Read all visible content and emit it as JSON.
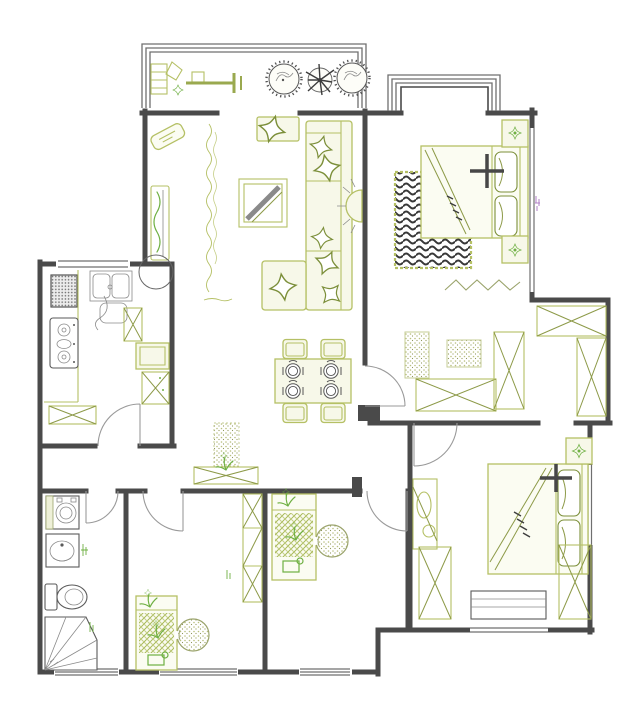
{
  "document": {
    "type": "apartment-floor-plan-drawing",
    "view": "top-down",
    "style": "CAD line drawing, black walls with olive-green furniture symbols"
  },
  "colors": {
    "wall": "#4a4a4a",
    "wall-light": "#6f6f6f",
    "furn": "#b5c065",
    "furn-dark": "#8d9a48",
    "furn-fill": "#f7f8e9",
    "plant": "#6fb043",
    "dark": "#3d3d3d",
    "door": "#9a9a9a",
    "purple": "#b07fc7",
    "bg": "#ffffff"
  },
  "rooms": [
    {
      "name": "balcony",
      "furniture": [
        "exercise-equipment-icon",
        "potted-plant-icon",
        "potted-plant-icon",
        "potted-plant-icon"
      ]
    },
    {
      "name": "living-room",
      "furniture": [
        "tv-icon",
        "tv-cabinet-icon",
        "wall-texture-scribble",
        "coffee-table-icon",
        "side-table-icon",
        "l-shaped-sofa-icon",
        "throw-pillow-icon",
        "wall-lamp-icon",
        "detail-circle-annotation"
      ]
    },
    {
      "name": "dining-area",
      "furniture": [
        "dining-table-icon",
        "chair-icon",
        "chair-icon",
        "chair-icon",
        "chair-icon",
        "place-setting-icon",
        "place-setting-icon",
        "place-setting-icon",
        "place-setting-icon"
      ]
    },
    {
      "name": "kitchen",
      "furniture": [
        "fridge-icon",
        "gas-stove-icon",
        "double-sink-icon",
        "counter-icon",
        "cabinet-x-icon",
        "cabinet-x-icon",
        "cabinet-icon",
        "bench-x-icon",
        "door-swing"
      ]
    },
    {
      "name": "hallway",
      "furniture": [
        "console-x-icon",
        "runner-rug-icon",
        "small-plant-icon"
      ]
    },
    {
      "name": "master-bedroom",
      "furniture": [
        "double-bed-icon",
        "pillow-icon",
        "pillow-icon",
        "nightstand-flower-icon",
        "nightstand-flower-icon",
        "swirl-rug-icon",
        "zigzag-decor",
        "dotted-mat-icon",
        "dotted-mat-icon",
        "wardrobe-x-icon",
        "wardrobe-x-icon",
        "bay-window",
        "door-swing"
      ]
    },
    {
      "name": "walk-in-closet",
      "furniture": [
        "wardrobe-x-icon",
        "wardrobe-x-icon"
      ]
    },
    {
      "name": "bedroom-2",
      "furniture": [
        "double-bed-icon",
        "pillow-icon",
        "pillow-icon",
        "potted-plant-square-icon",
        "dressing-table-icon",
        "wardrobe-x-icon",
        "wardrobe-x-icon",
        "desk-icon",
        "door-swing"
      ]
    },
    {
      "name": "bedroom-3",
      "furniture": [
        "single-bed-floral-icon",
        "dotted-pouf-icon",
        "wardrobe-column-icon",
        "door-swing"
      ]
    },
    {
      "name": "bedroom-4",
      "furniture": [
        "single-bed-floral-icon",
        "dotted-pouf-icon",
        "door-swing"
      ]
    },
    {
      "name": "bathroom",
      "furniture": [
        "washing-machine-icon",
        "wash-basin-icon",
        "toilet-icon",
        "corner-shower-icon",
        "door-swing"
      ]
    }
  ],
  "annotations": {
    "detail_circle_count": 1,
    "dimension_marks": [
      "tiny-green-illegible",
      "tiny-purple-illegible"
    ]
  }
}
